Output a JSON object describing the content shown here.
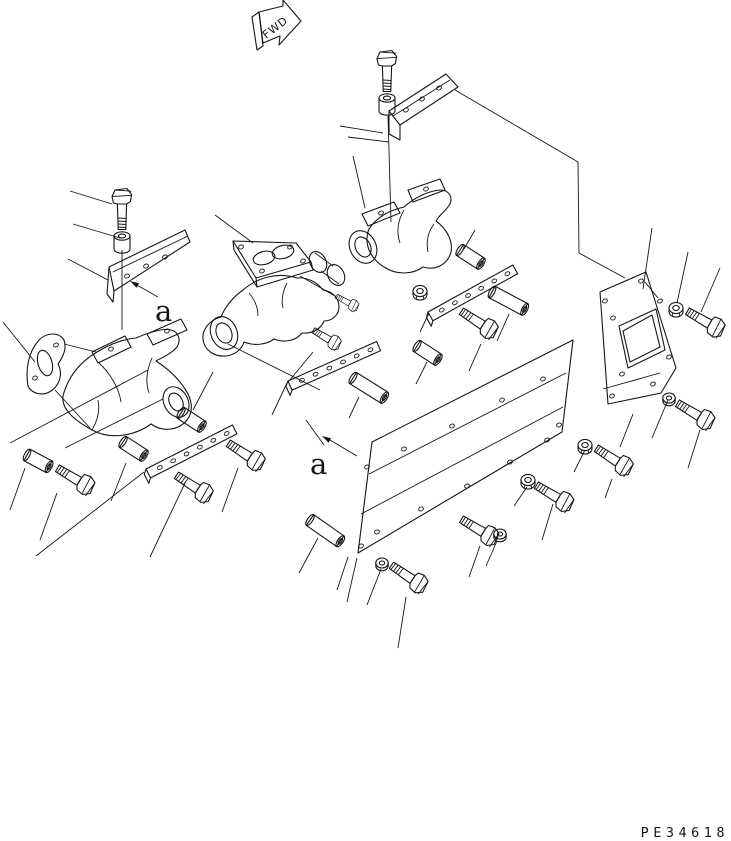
{
  "diagram": {
    "type": "exploded-parts-diagram",
    "subject": "exhaust-manifold-assembly",
    "background_color": "#ffffff",
    "line_color": "#161616",
    "direction_marker": {
      "label": "FWD"
    },
    "section_view": {
      "label_1": "a",
      "label_2": "a"
    },
    "drawing_number": "PE34618",
    "parts": [
      {
        "name": "heat-shield-plate-top"
      },
      {
        "name": "heat-shield-plate-left"
      },
      {
        "name": "exhaust-manifold-left"
      },
      {
        "name": "exhaust-manifold-center"
      },
      {
        "name": "exhaust-manifold-right"
      },
      {
        "name": "inlet-flange-plate"
      },
      {
        "name": "side-cover-panel"
      },
      {
        "name": "end-plate-with-square-opening"
      },
      {
        "name": "seal-strip",
        "count": 3
      },
      {
        "name": "connector-sleeve",
        "count": 8
      },
      {
        "name": "hex-bolt",
        "count": 13
      },
      {
        "name": "stud",
        "count": 2
      },
      {
        "name": "nut",
        "count": 6
      },
      {
        "name": "washer",
        "count": 3
      }
    ]
  }
}
